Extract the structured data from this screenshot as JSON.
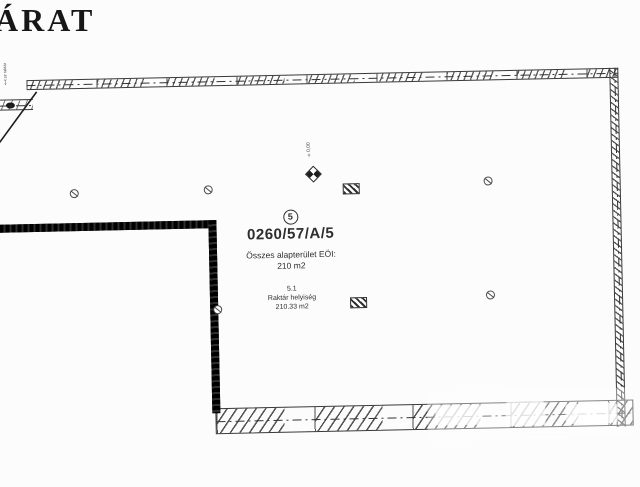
{
  "colors": {
    "background": "#fcfcfc",
    "ink": "#2b2b2b",
    "wall_dark": "#161616"
  },
  "title": "ÁRAT",
  "margin_note": {
    "line1": "fsz.",
    "line2": "t.sz raktár",
    "arrow": "↓"
  },
  "level_marker": {
    "label": "±0,00"
  },
  "unit_block": {
    "unit_circle_number": "5",
    "parcel_number": "0260/57/A/5",
    "total_area_label": "Összes alapterület EÖI:",
    "total_area_value": "210 m2",
    "room_code": "5.1",
    "room_name": "Raktár helyiség",
    "room_area": "210.33 m2"
  },
  "icons": {
    "circle_symbol": "circle-slash-drain",
    "column_symbol": "hatched-column",
    "level_symbol": "benchmark-diamond"
  }
}
